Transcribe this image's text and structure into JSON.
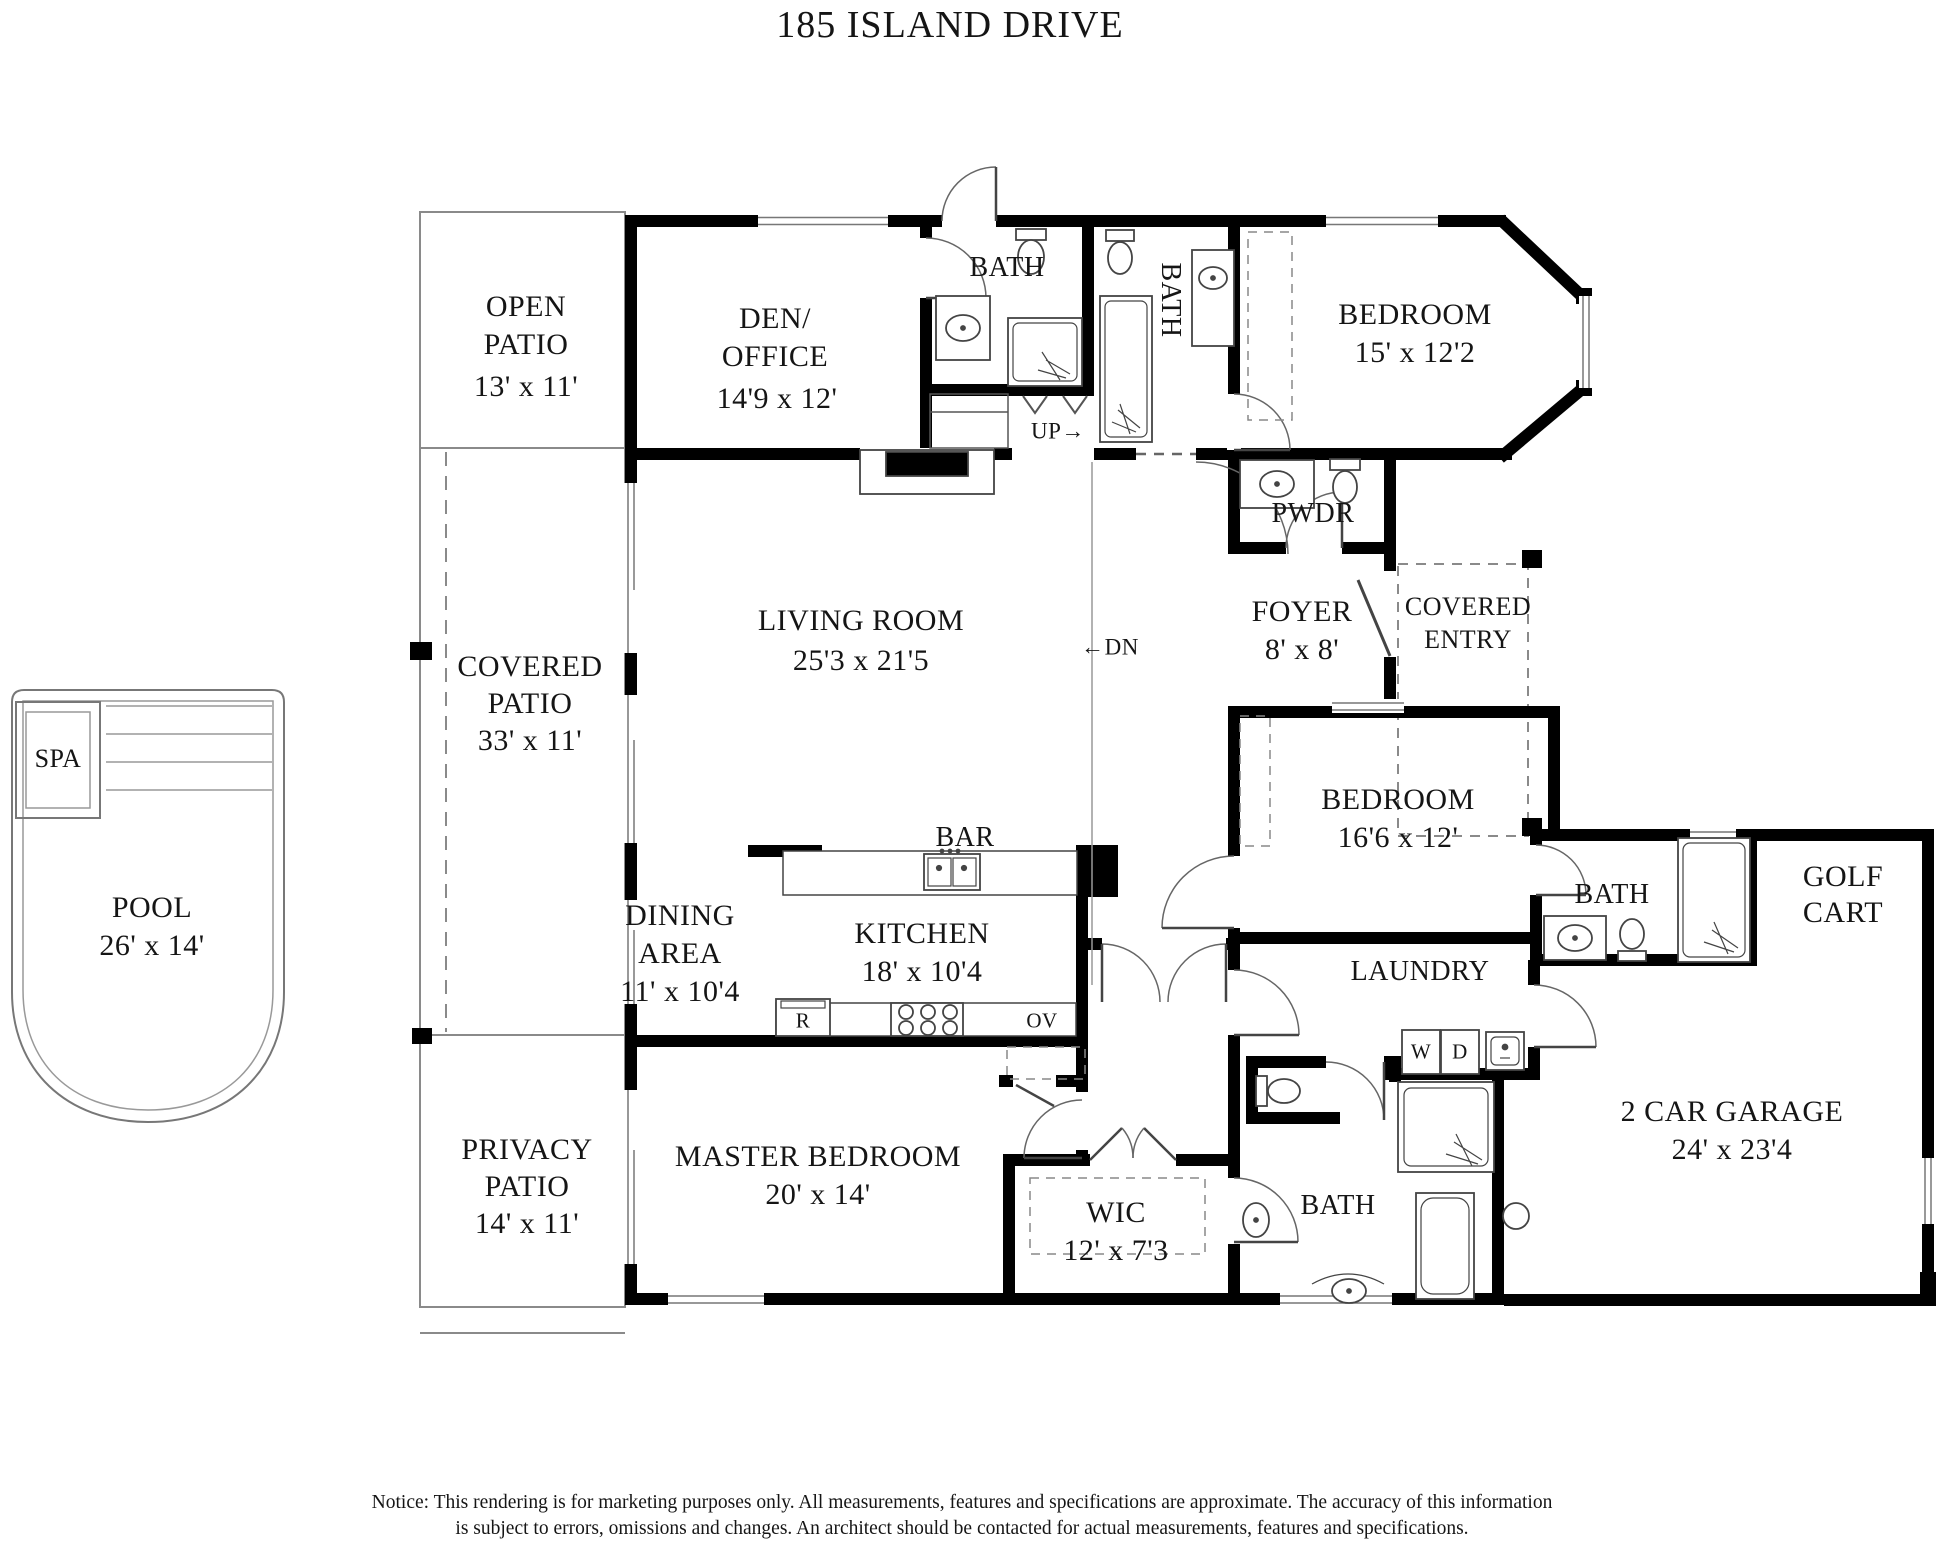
{
  "title": "185 ISLAND DRIVE",
  "notice": {
    "line1": "Notice: This rendering is for marketing purposes only. All measurements, features and specifications are approximate. The accuracy of this information",
    "line2": "is subject to errors, omissions and changes. An architect should be contacted for actual measurements, features and specifications."
  },
  "labels": [
    {
      "id": "open-patio-name-1",
      "text": "OPEN",
      "x": 526,
      "y": 307,
      "fs": 30
    },
    {
      "id": "open-patio-name-2",
      "text": "PATIO",
      "x": 526,
      "y": 345,
      "fs": 30
    },
    {
      "id": "open-patio-dims",
      "text": "13' x 11'",
      "x": 526,
      "y": 387,
      "fs": 30
    },
    {
      "id": "den-office-name-1",
      "text": "DEN/",
      "x": 775,
      "y": 319,
      "fs": 30
    },
    {
      "id": "den-office-name-2",
      "text": "OFFICE",
      "x": 775,
      "y": 357,
      "fs": 30
    },
    {
      "id": "den-office-dims",
      "text": "14'9 x 12'",
      "x": 777,
      "y": 399,
      "fs": 30
    },
    {
      "id": "bath-1-name",
      "text": "BATH",
      "x": 1007,
      "y": 268,
      "fs": 28
    },
    {
      "id": "bath-2-name",
      "text": "BATH",
      "x": 1170,
      "y": 300,
      "fs": 28,
      "rot": 90
    },
    {
      "id": "bedroom-1-name",
      "text": "BEDROOM",
      "x": 1415,
      "y": 315,
      "fs": 30
    },
    {
      "id": "bedroom-1-dims",
      "text": "15' x 12'2",
      "x": 1415,
      "y": 353,
      "fs": 30
    },
    {
      "id": "pwdr-name",
      "text": "PWDR",
      "x": 1313,
      "y": 514,
      "fs": 28
    },
    {
      "id": "up-label",
      "text": "UP→",
      "x": 1058,
      "y": 431,
      "fs": 23
    },
    {
      "id": "dn-label",
      "text": "←DN",
      "x": 1110,
      "y": 647,
      "fs": 23
    },
    {
      "id": "living-room-name",
      "text": "LIVING ROOM",
      "x": 861,
      "y": 621,
      "fs": 30
    },
    {
      "id": "living-room-dims",
      "text": "25'3 x 21'5",
      "x": 861,
      "y": 661,
      "fs": 30
    },
    {
      "id": "foyer-name",
      "text": "FOYER",
      "x": 1302,
      "y": 612,
      "fs": 30
    },
    {
      "id": "foyer-dims",
      "text": "8' x 8'",
      "x": 1302,
      "y": 650,
      "fs": 30
    },
    {
      "id": "covered-entry-name-1",
      "text": "COVERED",
      "x": 1468,
      "y": 607,
      "fs": 26
    },
    {
      "id": "covered-entry-name-2",
      "text": "ENTRY",
      "x": 1468,
      "y": 640,
      "fs": 26
    },
    {
      "id": "covered-patio-name-1",
      "text": "COVERED",
      "x": 530,
      "y": 667,
      "fs": 30
    },
    {
      "id": "covered-patio-name-2",
      "text": "PATIO",
      "x": 530,
      "y": 704,
      "fs": 30
    },
    {
      "id": "covered-patio-dims",
      "text": "33' x 11'",
      "x": 530,
      "y": 741,
      "fs": 30
    },
    {
      "id": "spa-name",
      "text": "SPA",
      "x": 58,
      "y": 759,
      "fs": 26
    },
    {
      "id": "pool-name",
      "text": "POOL",
      "x": 152,
      "y": 908,
      "fs": 30
    },
    {
      "id": "pool-dims",
      "text": "26' x 14'",
      "x": 152,
      "y": 946,
      "fs": 30
    },
    {
      "id": "bar-name",
      "text": "BAR",
      "x": 965,
      "y": 838,
      "fs": 28
    },
    {
      "id": "bedroom-2-name",
      "text": "BEDROOM",
      "x": 1398,
      "y": 800,
      "fs": 30
    },
    {
      "id": "bedroom-2-dims",
      "text": "16'6 x 12'",
      "x": 1398,
      "y": 838,
      "fs": 30
    },
    {
      "id": "bath-3-name",
      "text": "BATH",
      "x": 1612,
      "y": 895,
      "fs": 28
    },
    {
      "id": "golf-cart-name-1",
      "text": "GOLF",
      "x": 1843,
      "y": 877,
      "fs": 30
    },
    {
      "id": "golf-cart-name-2",
      "text": "CART",
      "x": 1843,
      "y": 913,
      "fs": 30
    },
    {
      "id": "dining-area-name-1",
      "text": "DINING",
      "x": 680,
      "y": 916,
      "fs": 30
    },
    {
      "id": "dining-area-name-2",
      "text": "AREA",
      "x": 680,
      "y": 954,
      "fs": 30
    },
    {
      "id": "dining-area-dims",
      "text": "11' x 10'4",
      "x": 680,
      "y": 992,
      "fs": 30
    },
    {
      "id": "kitchen-name",
      "text": "KITCHEN",
      "x": 922,
      "y": 934,
      "fs": 30
    },
    {
      "id": "kitchen-dims",
      "text": "18' x 10'4",
      "x": 922,
      "y": 972,
      "fs": 30
    },
    {
      "id": "laundry-name",
      "text": "LAUNDRY",
      "x": 1420,
      "y": 972,
      "fs": 28
    },
    {
      "id": "range-label",
      "text": "R",
      "x": 803,
      "y": 1021,
      "fs": 21
    },
    {
      "id": "oven-label",
      "text": "OV",
      "x": 1042,
      "y": 1021,
      "fs": 21
    },
    {
      "id": "washer-label",
      "text": "W",
      "x": 1421,
      "y": 1052,
      "fs": 21
    },
    {
      "id": "dryer-label",
      "text": "D",
      "x": 1460,
      "y": 1052,
      "fs": 21
    },
    {
      "id": "privacy-patio-name-1",
      "text": "PRIVACY",
      "x": 527,
      "y": 1150,
      "fs": 30
    },
    {
      "id": "privacy-patio-name-2",
      "text": "PATIO",
      "x": 527,
      "y": 1187,
      "fs": 30
    },
    {
      "id": "privacy-patio-dims",
      "text": "14' x 11'",
      "x": 527,
      "y": 1224,
      "fs": 30
    },
    {
      "id": "master-bedroom-name",
      "text": "MASTER BEDROOM",
      "x": 818,
      "y": 1157,
      "fs": 30
    },
    {
      "id": "master-bedroom-dims",
      "text": "20' x 14'",
      "x": 818,
      "y": 1195,
      "fs": 30
    },
    {
      "id": "wic-name",
      "text": "WIC",
      "x": 1116,
      "y": 1213,
      "fs": 30
    },
    {
      "id": "wic-dims",
      "text": "12' x 7'3",
      "x": 1116,
      "y": 1251,
      "fs": 30
    },
    {
      "id": "bath-4-name",
      "text": "BATH",
      "x": 1338,
      "y": 1206,
      "fs": 28
    },
    {
      "id": "garage-name",
      "text": "2 CAR GARAGE",
      "x": 1732,
      "y": 1112,
      "fs": 30
    },
    {
      "id": "garage-dims",
      "text": "24' x 23'4",
      "x": 1732,
      "y": 1150,
      "fs": 30
    }
  ]
}
